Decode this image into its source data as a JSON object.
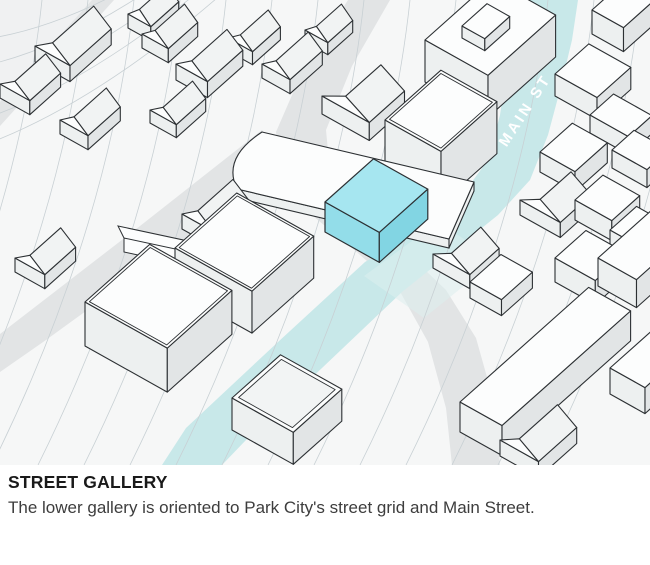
{
  "figure": {
    "caption_title": "STREET GALLERY",
    "caption_body": "The lower gallery is oriented to Park City's street grid and Main Street."
  },
  "map": {
    "street_label": "MAIN ST",
    "colors": {
      "background": "#f6f7f7",
      "wash": "#f0f1f2",
      "contour": "#c8d0d4",
      "side_street": "#e2e4e5",
      "main_street": "#c8e8e9",
      "intersection": "#ddefef",
      "outline": "#2c3033",
      "building_top": "#fcfdfd",
      "building_left": "#edf0f0",
      "building_right": "#e2e5e6",
      "roof": "#f1f3f3",
      "highlight_top": "#a6e6f0",
      "highlight_left": "#93dde9",
      "highlight_right": "#82d5e3",
      "label": "#ffffff"
    }
  }
}
